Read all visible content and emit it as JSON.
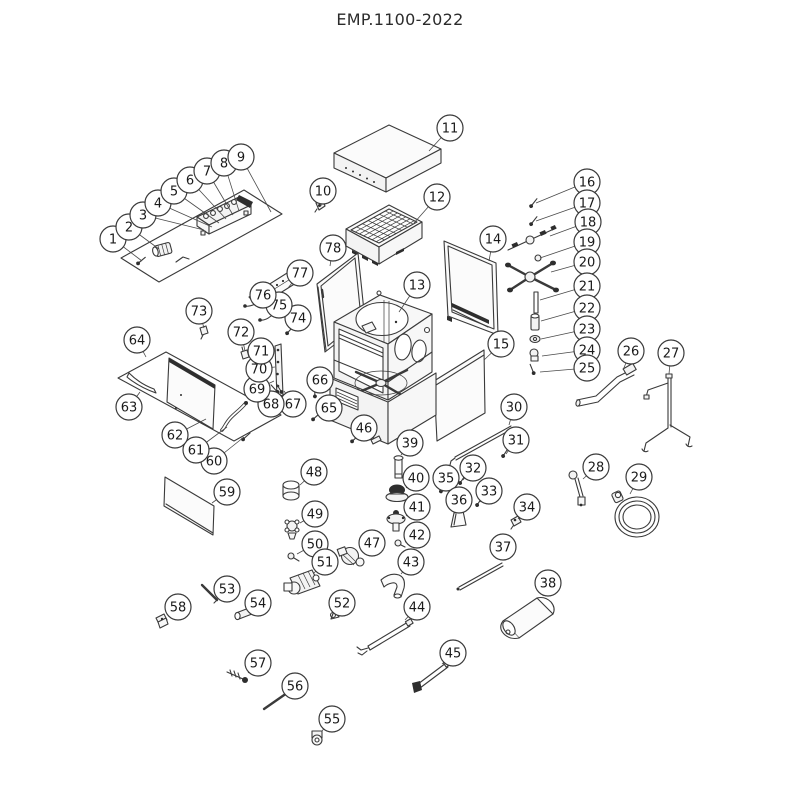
{
  "page": {
    "title": "EMP.1100-2022"
  },
  "colors": {
    "background": "#ffffff",
    "line": "#3a3a3a",
    "leader": "#4a4a4a",
    "balloon_fill": "#ffffff",
    "balloon_stroke": "#3a3a3a",
    "number_text": "#1a1a1a"
  },
  "balloon_style": {
    "radius": 13,
    "font_size": 13
  },
  "balloons": [
    {
      "n": "1",
      "x": 113,
      "y": 239,
      "tx": 142,
      "ty": 261
    },
    {
      "n": "2",
      "x": 129,
      "y": 227,
      "tx": 159,
      "ty": 249
    },
    {
      "n": "3",
      "x": 143,
      "y": 215,
      "tx": 204,
      "ty": 230
    },
    {
      "n": "4",
      "x": 158,
      "y": 203,
      "tx": 212,
      "ty": 227
    },
    {
      "n": "5",
      "x": 174,
      "y": 191,
      "tx": 219,
      "ty": 223
    },
    {
      "n": "6",
      "x": 190,
      "y": 180,
      "tx": 226,
      "ty": 219
    },
    {
      "n": "7",
      "x": 207,
      "y": 171,
      "tx": 233,
      "ty": 215
    },
    {
      "n": "8",
      "x": 224,
      "y": 163,
      "tx": 239,
      "ty": 211
    },
    {
      "n": "9",
      "x": 241,
      "y": 157,
      "tx": 271,
      "ty": 212
    },
    {
      "n": "10",
      "x": 323,
      "y": 191,
      "tx": 321,
      "ty": 206
    },
    {
      "n": "11",
      "x": 450,
      "y": 128,
      "tx": 429,
      "ty": 151
    },
    {
      "n": "12",
      "x": 437,
      "y": 197,
      "tx": 414,
      "ty": 223
    },
    {
      "n": "13",
      "x": 417,
      "y": 285,
      "tx": 399,
      "ty": 312
    },
    {
      "n": "14",
      "x": 493,
      "y": 239,
      "tx": 489,
      "ty": 261
    },
    {
      "n": "15",
      "x": 501,
      "y": 344,
      "tx": 484,
      "ty": 360
    },
    {
      "n": "16",
      "x": 587,
      "y": 182,
      "tx": 536,
      "ty": 203
    },
    {
      "n": "17",
      "x": 587,
      "y": 203,
      "tx": 536,
      "ty": 221
    },
    {
      "n": "18",
      "x": 588,
      "y": 222,
      "tx": 550,
      "ty": 236
    },
    {
      "n": "19",
      "x": 587,
      "y": 242,
      "tx": 540,
      "ty": 258
    },
    {
      "n": "20",
      "x": 587,
      "y": 262,
      "tx": 551,
      "ty": 272
    },
    {
      "n": "21",
      "x": 587,
      "y": 286,
      "tx": 540,
      "ty": 300
    },
    {
      "n": "22",
      "x": 587,
      "y": 308,
      "tx": 541,
      "ty": 321
    },
    {
      "n": "23",
      "x": 587,
      "y": 329,
      "tx": 541,
      "ty": 339
    },
    {
      "n": "24",
      "x": 587,
      "y": 350,
      "tx": 542,
      "ty": 356
    },
    {
      "n": "25",
      "x": 587,
      "y": 368,
      "tx": 540,
      "ty": 372
    },
    {
      "n": "26",
      "x": 631,
      "y": 351,
      "tx": 623,
      "ty": 370
    },
    {
      "n": "27",
      "x": 671,
      "y": 353,
      "tx": 669,
      "ty": 374
    },
    {
      "n": "28",
      "x": 596,
      "y": 467,
      "tx": 583,
      "ty": 479
    },
    {
      "n": "29",
      "x": 639,
      "y": 477,
      "tx": 630,
      "ty": 494
    },
    {
      "n": "30",
      "x": 514,
      "y": 407,
      "tx": 509,
      "ty": 425
    },
    {
      "n": "31",
      "x": 516,
      "y": 440,
      "tx": 506,
      "ty": 454
    },
    {
      "n": "32",
      "x": 473,
      "y": 468,
      "tx": 463,
      "ty": 480
    },
    {
      "n": "33",
      "x": 489,
      "y": 491,
      "tx": 480,
      "ty": 502
    },
    {
      "n": "34",
      "x": 527,
      "y": 507,
      "tx": 518,
      "ty": 519
    },
    {
      "n": "35",
      "x": 446,
      "y": 478,
      "tx": 443,
      "ty": 489
    },
    {
      "n": "36",
      "x": 459,
      "y": 500,
      "tx": 459,
      "ty": 512
    },
    {
      "n": "37",
      "x": 503,
      "y": 547,
      "tx": 498,
      "ty": 559
    },
    {
      "n": "38",
      "x": 548,
      "y": 583,
      "tx": 543,
      "ty": 596
    },
    {
      "n": "39",
      "x": 410,
      "y": 443,
      "tx": 401,
      "ty": 455
    },
    {
      "n": "40",
      "x": 416,
      "y": 478,
      "tx": 406,
      "ty": 488
    },
    {
      "n": "41",
      "x": 417,
      "y": 507,
      "tx": 406,
      "ty": 516
    },
    {
      "n": "42",
      "x": 417,
      "y": 535,
      "tx": 405,
      "ty": 542
    },
    {
      "n": "43",
      "x": 411,
      "y": 562,
      "tx": 401,
      "ty": 574
    },
    {
      "n": "44",
      "x": 417,
      "y": 607,
      "tx": 405,
      "ty": 620
    },
    {
      "n": "45",
      "x": 453,
      "y": 653,
      "tx": 442,
      "ty": 664
    },
    {
      "n": "46",
      "x": 364,
      "y": 428,
      "tx": 356,
      "ty": 438
    },
    {
      "n": "47",
      "x": 372,
      "y": 543,
      "tx": 361,
      "ty": 551
    },
    {
      "n": "48",
      "x": 314,
      "y": 472,
      "tx": 300,
      "ty": 485
    },
    {
      "n": "49",
      "x": 315,
      "y": 514,
      "tx": 300,
      "ty": 523
    },
    {
      "n": "50",
      "x": 315,
      "y": 544,
      "tx": 297,
      "ty": 554
    },
    {
      "n": "51",
      "x": 325,
      "y": 562,
      "tx": 314,
      "ty": 573
    },
    {
      "n": "52",
      "x": 342,
      "y": 603,
      "tx": 335,
      "ty": 613
    },
    {
      "n": "53",
      "x": 227,
      "y": 589,
      "tx": 218,
      "ty": 598
    },
    {
      "n": "54",
      "x": 258,
      "y": 603,
      "tx": 249,
      "ty": 611
    },
    {
      "n": "55",
      "x": 332,
      "y": 719,
      "tx": 322,
      "ty": 731
    },
    {
      "n": "56",
      "x": 295,
      "y": 686,
      "tx": 286,
      "ty": 695
    },
    {
      "n": "57",
      "x": 258,
      "y": 663,
      "tx": 248,
      "ty": 673
    },
    {
      "n": "58",
      "x": 178,
      "y": 607,
      "tx": 168,
      "ty": 616
    },
    {
      "n": "59",
      "x": 227,
      "y": 492,
      "tx": 212,
      "ty": 503
    },
    {
      "n": "60",
      "x": 214,
      "y": 461,
      "tx": 244,
      "ty": 437
    },
    {
      "n": "61",
      "x": 196,
      "y": 450,
      "tx": 227,
      "ty": 427
    },
    {
      "n": "62",
      "x": 175,
      "y": 435,
      "tx": 206,
      "ty": 419
    },
    {
      "n": "63",
      "x": 129,
      "y": 407,
      "tx": 140,
      "ty": 392
    },
    {
      "n": "64",
      "x": 137,
      "y": 340,
      "tx": 146,
      "ty": 357
    },
    {
      "n": "65",
      "x": 329,
      "y": 408,
      "tx": 317,
      "ty": 416
    },
    {
      "n": "66",
      "x": 320,
      "y": 380,
      "tx": 316,
      "ty": 393
    },
    {
      "n": "67",
      "x": 293,
      "y": 404,
      "tx": 284,
      "ty": 391
    },
    {
      "n": "68",
      "x": 271,
      "y": 404,
      "tx": 277,
      "ty": 392
    },
    {
      "n": "69",
      "x": 257,
      "y": 389,
      "tx": 274,
      "ty": 381
    },
    {
      "n": "70",
      "x": 259,
      "y": 369,
      "tx": 275,
      "ty": 367
    },
    {
      "n": "71",
      "x": 261,
      "y": 351,
      "tx": 276,
      "ty": 351
    },
    {
      "n": "72",
      "x": 241,
      "y": 332,
      "tx": 245,
      "ty": 351
    },
    {
      "n": "73",
      "x": 199,
      "y": 311,
      "tx": 204,
      "ty": 328
    },
    {
      "n": "74",
      "x": 298,
      "y": 318,
      "tx": 290,
      "ty": 330
    },
    {
      "n": "75",
      "x": 279,
      "y": 305,
      "tx": 271,
      "ty": 316
    },
    {
      "n": "76",
      "x": 263,
      "y": 295,
      "tx": 255,
      "ty": 304
    },
    {
      "n": "77",
      "x": 300,
      "y": 273,
      "tx": 288,
      "ty": 288
    },
    {
      "n": "78",
      "x": 333,
      "y": 248,
      "tx": 330,
      "ty": 266
    }
  ]
}
